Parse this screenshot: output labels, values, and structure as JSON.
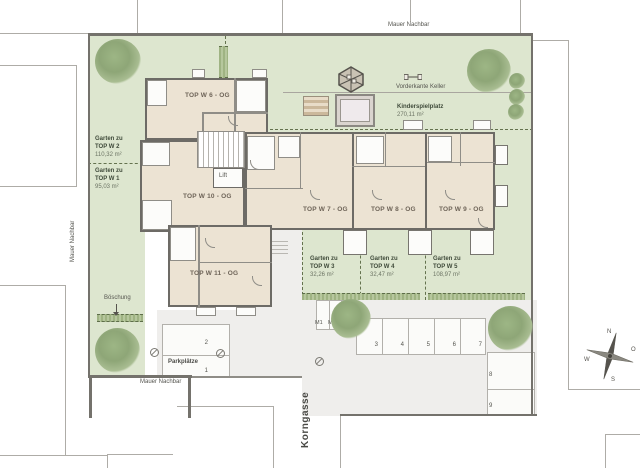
{
  "labels": {
    "mauer_top": "Mauer Nachbar",
    "mauer_left": "Mauer Nachbar",
    "mauer_bottom": "Mauer Nachbar",
    "street": "Korngasse",
    "vorderkante": "Vorderkante Keller",
    "boeschung": "Böschung",
    "lift": "Lift"
  },
  "playground": {
    "name": "Kinderspielplatz",
    "area": "270,11 m²"
  },
  "units": {
    "w6": "TOP W 6 - OG",
    "w7": "TOP W 7 - OG",
    "w8": "TOP W 8 - OG",
    "w9": "TOP W 9 - OG",
    "w10": "TOP W 10 - OG",
    "w11": "TOP W 11 - OG"
  },
  "gardens": [
    {
      "line1": "Garten zu",
      "line2": "TOP W 2",
      "area": "110,32 m²"
    },
    {
      "line1": "Garten zu",
      "line2": "TOP W 1",
      "area": "95,03 m²"
    },
    {
      "line1": "Garten zu",
      "line2": "TOP W 3",
      "area": "32,26 m²"
    },
    {
      "line1": "Garten zu",
      "line2": "TOP W 4",
      "area": "32,47 m²"
    },
    {
      "line1": "Garten zu",
      "line2": "TOP W 5",
      "area": "108,97 m²"
    }
  ],
  "parking": {
    "title": "Parkplätze",
    "stalls": [
      "1",
      "2",
      "3",
      "4",
      "5",
      "6",
      "7",
      "8",
      "9"
    ],
    "moto": [
      "M1",
      "M2",
      "M3"
    ]
  },
  "compass": {
    "n": "N",
    "o": "O",
    "s": "S",
    "w": "W"
  },
  "colors": {
    "site_green": "#dde6cf",
    "floor_beige": "#ece3d3",
    "wall_gray": "#6d6b66",
    "paving_gray": "#efeeec",
    "tree_green": "#93ad7e",
    "hedge_green": "#a9bc8e"
  }
}
